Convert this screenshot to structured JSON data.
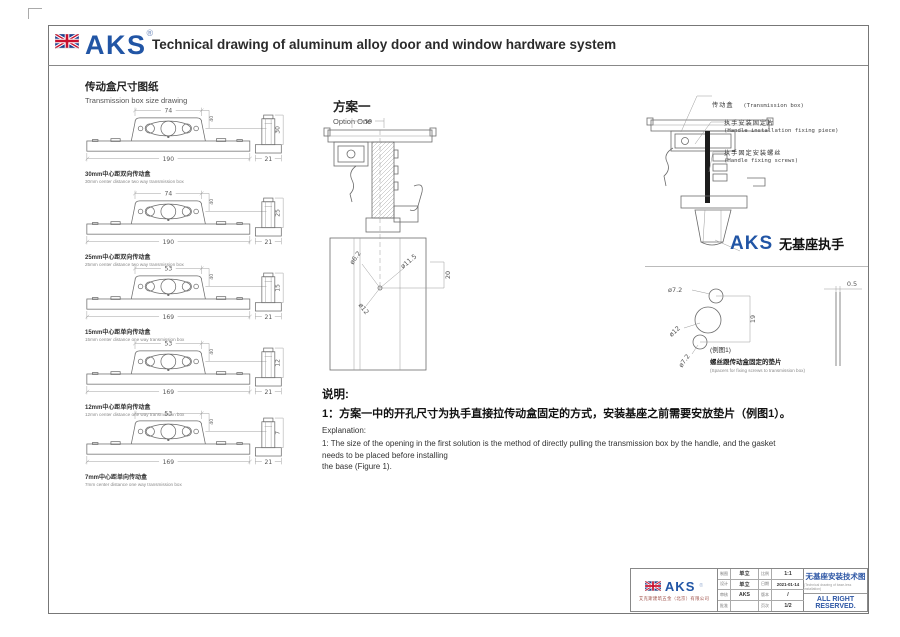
{
  "header": {
    "brand": "AKS",
    "brand_reg": "®",
    "title": "Technical drawing of aluminum alloy door and window hardware system"
  },
  "left_column": {
    "section_title_zh": "传动盒尺寸图纸",
    "section_title_en": "Transmission box size drawing",
    "boxes": [
      {
        "dim_top": "74",
        "dim_bottom": "190",
        "dim_end": "21",
        "dim_side": "30",
        "dim_small": "40",
        "caption_zh": "30mm中心距双向传动盒",
        "caption_en": "30mm center distance two way transmission box"
      },
      {
        "dim_top": "74",
        "dim_bottom": "190",
        "dim_end": "21",
        "dim_side": "25",
        "dim_small": "40",
        "caption_zh": "25mm中心距双向传动盒",
        "caption_en": "25mm center distance two way transmission box"
      },
      {
        "dim_top": "53",
        "dim_bottom": "169",
        "dim_end": "21",
        "dim_side": "15",
        "dim_small": "40",
        "caption_zh": "15mm中心距单向传动盒",
        "caption_en": "15mm center distance one way transmission box"
      },
      {
        "dim_top": "53",
        "dim_bottom": "169",
        "dim_end": "21",
        "dim_side": "12",
        "dim_small": "40",
        "caption_zh": "12mm中心距单向传动盒",
        "caption_en": "12mm center distance one way transmission box"
      },
      {
        "dim_top": "53",
        "dim_bottom": "169",
        "dim_end": "21",
        "dim_side": "7",
        "dim_small": "40",
        "caption_zh": "7mm中心距单向传动盒",
        "caption_en": "7mm center distance one way transmission box"
      }
    ]
  },
  "middle": {
    "option_title_zh": "方案一",
    "option_title_en": "Option One",
    "section_dims": {
      "top": "30",
      "hole1": "ø6.2",
      "hole2": "ø11.5",
      "offset": "20",
      "hole3": "ø12"
    },
    "notes": {
      "heading_zh": "说明:",
      "line1_zh": "1：方案一中的开孔尺寸为执手直接拉传动盒固定的方式，安装基座之前需要安放垫片（例图1）。",
      "heading_en": "Explanation:",
      "line1_en": "1: The size of the opening in the first solution is the method of directly pulling the transmission box by the handle, and the gasket needs to be placed before installing",
      "line2_en": "the base (Figure 1)."
    }
  },
  "right_column": {
    "labels": [
      {
        "zh": "传动盒",
        "en": "(Transmission box)"
      },
      {
        "zh": "执手安装固定片",
        "en": "(Handle installation fixing piece)"
      },
      {
        "zh": "执手固定安装螺丝",
        "en": "(Handle fixing screws)"
      }
    ],
    "product_brand": "AKS",
    "product_name_zh": "无基座执手",
    "gasket": {
      "dim_hole_top": "ø7.2",
      "dim_hole_mid": "ø12",
      "dim_hole_bottom": "ø7.2",
      "dim_height": "19",
      "dim_thickness": "0.5",
      "caption_fig": "(例图1)",
      "caption_zh": "螺丝跟传动盒固定的垫片",
      "caption_en": "(Spacers for fixing screws to transmission box)"
    }
  },
  "title_block": {
    "brand": "AKS",
    "brand_reg": "®",
    "company_zh": "艾克斯建筑五金（北京）有限公司",
    "grid": {
      "rows": [
        {
          "l1": "制图",
          "v1": "单立",
          "l2": "比例",
          "v2": "1:1"
        },
        {
          "l1": "设计",
          "v1": "单立",
          "l2": "日期",
          "v2": "2021-01-14"
        },
        {
          "l1": "审核",
          "v1": "AKS",
          "l2": "版本",
          "v2": "/"
        },
        {
          "l1": "批准",
          "v1": "",
          "l2": "页次",
          "v2": "1/2"
        }
      ]
    },
    "doc_title_zh": "无基座安装技术图",
    "doc_subtitle_en": "(Technical drawing of base-less installation)",
    "rights": "ALL RIGHT RESERVED."
  },
  "colors": {
    "brand_blue": "#2155a5",
    "flag_red": "#c8102e",
    "flag_blue": "#1d3f8f",
    "line_gray": "#6b6b6b",
    "company_red": "#9b4a42"
  }
}
